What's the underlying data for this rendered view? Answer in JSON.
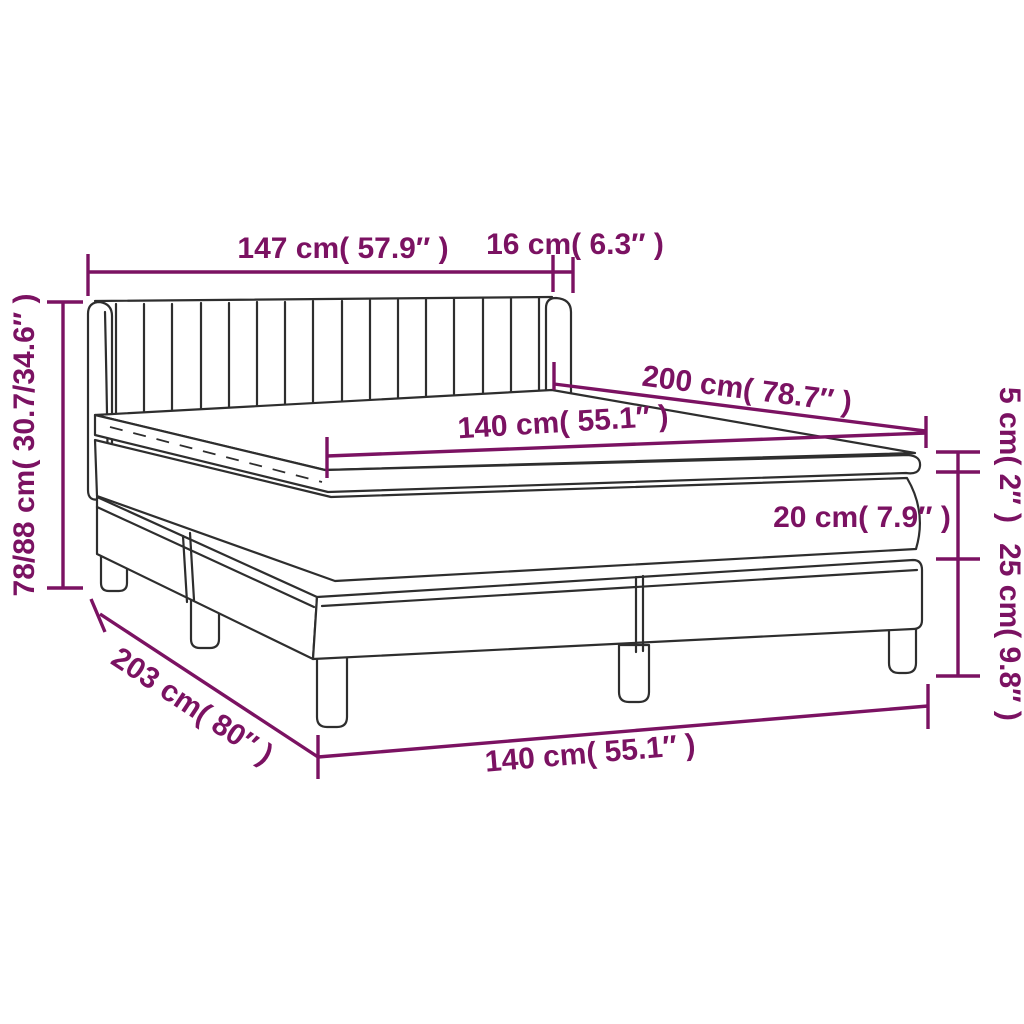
{
  "diagram": {
    "type": "product-dimension-diagram",
    "product": "box-spring-bed-with-headboard-mattress-and-topper",
    "background_color": "#ffffff",
    "accent_color": "#7b1262",
    "line_color": "#2e2e2e",
    "dimensions": [
      {
        "id": "headboard-width",
        "cm": "147",
        "inches": "57.9",
        "label": "147 cm( 57.9″ )"
      },
      {
        "id": "headboard-wing-depth",
        "cm": "16",
        "inches": "6.3",
        "label": "16 cm( 6.3″ )"
      },
      {
        "id": "bed-length",
        "cm": "200",
        "inches": "78.7",
        "label": "200 cm( 78.7″ )"
      },
      {
        "id": "mattress-width",
        "cm": "140",
        "inches": "55.1",
        "label": "140 cm( 55.1″ )"
      },
      {
        "id": "overall-height",
        "cm": "78/88",
        "inches": "30.7/34.6",
        "label": "78/88 cm( 30.7/34.6″ )"
      },
      {
        "id": "topper-thickness",
        "cm": "5",
        "inches": "2",
        "label": "5 cm( 2″ )"
      },
      {
        "id": "mattress-thickness",
        "cm": "20",
        "inches": "7.9",
        "label": "20 cm( 7.9″ )"
      },
      {
        "id": "base-height",
        "cm": "25",
        "inches": "9.8",
        "label": "25 cm( 9.8″ )"
      },
      {
        "id": "overall-length",
        "cm": "203",
        "inches": "80",
        "label": "203 cm( 80″ )"
      },
      {
        "id": "base-width",
        "cm": "140",
        "inches": "55.1",
        "label": "140 cm( 55.1″ )"
      }
    ]
  }
}
